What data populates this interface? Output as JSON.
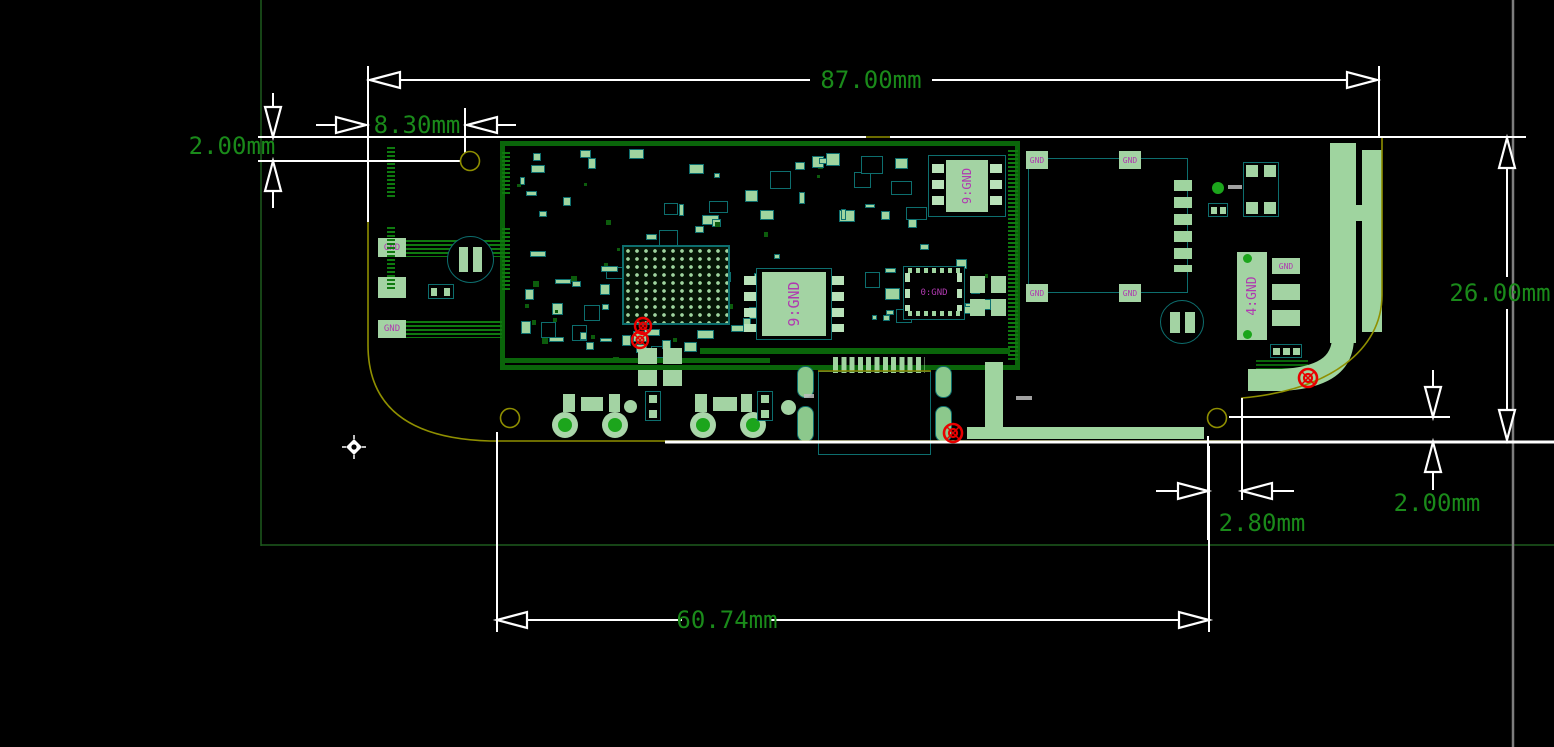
{
  "dimensions": {
    "board_width": "87.00mm",
    "top_hole_offset_x": "8.30mm",
    "top_hole_offset_y": "2.00mm",
    "board_height": "26.00mm",
    "bottom_right_offset_y": "2.00mm",
    "bottom_right_offset_x": "2.80mm",
    "bottom_hole_span": "60.74mm"
  },
  "board_labels": {
    "left_pad_top": "GND",
    "left_pad_bottom": "GND",
    "soic_center": "9:GND",
    "chip_top_right": "9:GND",
    "qfn_center": "0:GND",
    "right_chip": "4:GND",
    "right_chip_pad": "GND",
    "sd_pad_tl": "GND",
    "sd_pad_tr": "GND",
    "sd_pad_bl": "GND",
    "sd_pad_br": "GND"
  },
  "colors": {
    "background": "#000000",
    "dimension_text": "#1a8a1a",
    "dimension_lines": "#ffffff",
    "board_outline": "#8f8f00",
    "copper_pad": "#a3d3a3",
    "component_outline": "#0d6e6e",
    "ground_pour": "#0a650a",
    "silkscreen_text": "#b03ab0",
    "fiducial": "#e80000",
    "testpoint": "#1ca51c",
    "sheet_border": "#1d5a1d",
    "guide_line": "#7d7d7d"
  }
}
